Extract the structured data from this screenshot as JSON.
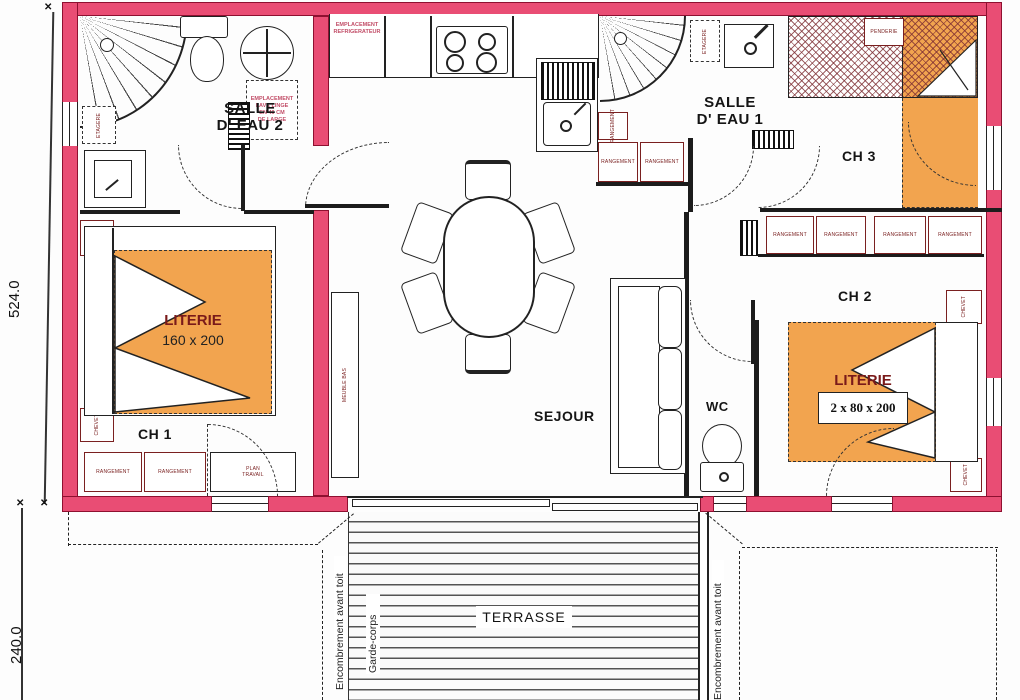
{
  "rooms": {
    "salle_eau_2": {
      "l1": "SALLE",
      "l2": "D' EAU 2"
    },
    "salle_eau_1": {
      "l1": "SALLE",
      "l2": "D' EAU 1"
    },
    "ch1": "CH 1",
    "ch2": "CH 2",
    "ch3": "CH 3",
    "sejour": "SEJOUR",
    "wc": "WC",
    "terrasse": "TERRASSE"
  },
  "beds": {
    "ch1": {
      "title": "LITERIE",
      "size": "160 x 200"
    },
    "ch2": {
      "title": "LITERIE",
      "size": "2 x 80 x 200"
    }
  },
  "notes": {
    "lave_linge": {
      "l1": "EMPLACEMENT",
      "l2": "LAVE LINGE",
      "l3": "EN 40 CM",
      "l4": "DE LARGE"
    },
    "refrigerateur": {
      "l1": "EMPLACEMENT",
      "l2": "REFRIGERATEUR"
    },
    "ouvrant_principal": {
      "l1": "Ouvrant",
      "l2": "Principal"
    },
    "ouvrant_semi_fixe": {
      "l1": "Ouvrant",
      "l2": "Semi fixe"
    },
    "encombrement": "Encombrement avant toit",
    "garde_corps": "Garde-corps"
  },
  "furniture": {
    "rangement": "RANGEMENT",
    "chevet": "CHEVET",
    "etagere": "ETAGERE",
    "meuble_bas": "MEUBLE BAS",
    "penderie": "PENDERIE",
    "plan_travail": {
      "l1": "PLAN",
      "l2": "TRAVAIL"
    }
  },
  "dimensions": {
    "height": "524.0",
    "terrace_depth": "240.0"
  },
  "colors": {
    "wall": "#e94d74",
    "bed": "#f2a44f",
    "label": "#7a2020",
    "red_text": "#c24e68"
  }
}
